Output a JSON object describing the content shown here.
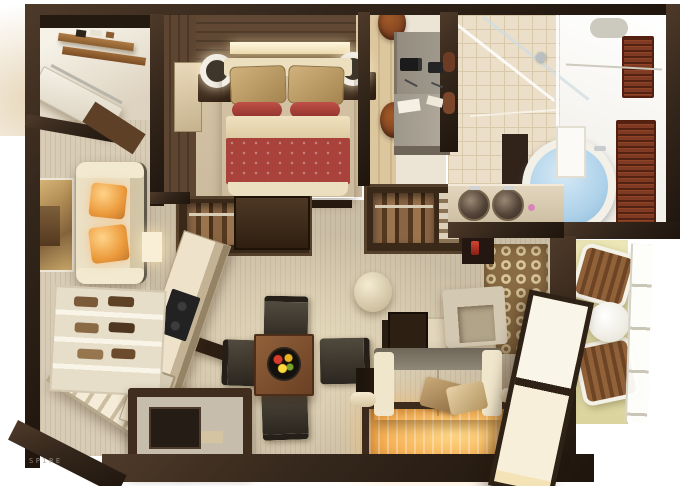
{
  "meta": {
    "watermark": "SPIRE"
  },
  "palette": {
    "wall": "#33261b",
    "wallLight": "#4e3a29",
    "wallDark": "#1f150d",
    "carpet": "#cbbea6",
    "carpetLeft": "#d8ccb6",
    "tile": "#ebdfc9",
    "tileLine": "#d9c9ab",
    "bathWhite": "#f7f5f0",
    "balcony": "#e9e3b2",
    "bedRed": "#a8423a",
    "bedCream": "#ecdfbf",
    "pillowTan": "#c29f69",
    "orange": "#ec9c3d",
    "sofaCream": "#ece2c8",
    "sofaGray": "#8f8878",
    "rugBorder": "#3c2b1d",
    "glow": "#ffd887",
    "patternBase": "#8a6c44",
    "patternRing": "#dbc79b",
    "shojiPane": "#f9f5e8",
    "shojiFrame": "#2e2116",
    "water": "#aed2ea",
    "wardrobe": "#3a2918",
    "wardrobeInner": "#6e4e33",
    "counter": "#eee3ca",
    "cooktop": "#222222",
    "chair": "#3a332b",
    "stool": "#7c3f1f",
    "desk": "#a29b8f",
    "louver": "#7e3a22",
    "accentRed": "#cf4533",
    "woodMid": "#7b5136",
    "artGold": "#c9a96a",
    "watermarkColor": "#a39b8e"
  },
  "rooms": [
    {
      "name": "storage-nook"
    },
    {
      "name": "bedroom"
    },
    {
      "name": "work-area"
    },
    {
      "name": "bathroom"
    },
    {
      "name": "dressing-area"
    },
    {
      "name": "kitchen"
    },
    {
      "name": "dining-area"
    },
    {
      "name": "living-area"
    },
    {
      "name": "lounge"
    },
    {
      "name": "balcony"
    }
  ],
  "furniture": [
    "double-bed",
    "nightstands",
    "wall-lamps",
    "wardrobes",
    "kitchen-counter",
    "cooktop",
    "dining-table",
    "dining-chairs",
    "fruit-bowl",
    "ottoman",
    "armchair",
    "patterned-rug",
    "sofa",
    "illuminated-rug",
    "shoji-screen",
    "bathtub",
    "double-sink-vanity",
    "shower",
    "lounge-chairs",
    "balcony-table",
    "coffee-table",
    "shoe-shelf",
    "work-desks",
    "stools",
    "left-sofa",
    "wall-art"
  ]
}
